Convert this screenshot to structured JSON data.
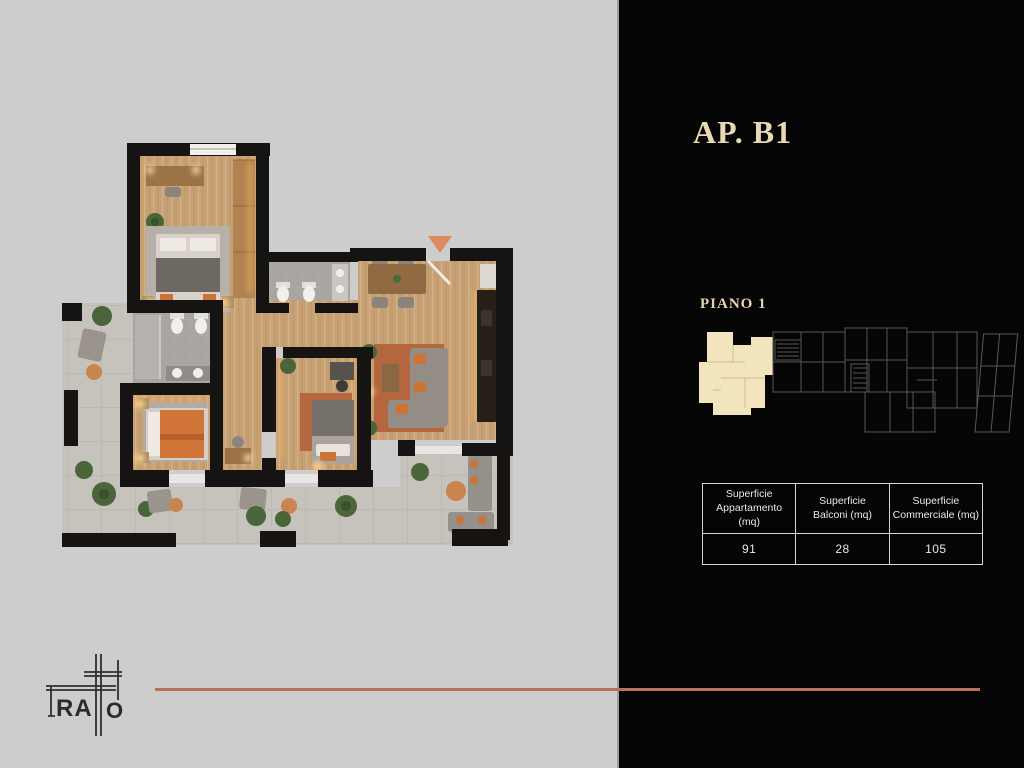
{
  "slide": {
    "apartment_title": "AP. B1",
    "floor_label": "PIANO 1"
  },
  "area_table": {
    "columns": [
      {
        "header_line1": "Superficie",
        "header_line2": "Appartamento (mq)",
        "value": "91"
      },
      {
        "header_line1": "Superficie",
        "header_line2": "Balconi (mq)",
        "value": "28"
      },
      {
        "header_line1": "Superficie",
        "header_line2": "Commerciale (mq)",
        "value": "105"
      }
    ]
  },
  "logo": {
    "brand": "TRATTO",
    "visible_letters": {
      "ra": "RA",
      "o": "O"
    }
  },
  "icons": {
    "entrance_marker": "triangle-down-icon"
  },
  "colors": {
    "accent_copper": "#b5745a",
    "title_cream": "#e9d9b3",
    "panel_black": "#050505",
    "canvas_gray": "#cdcdcd",
    "minimap_highlight": "#f2e5bd",
    "wall_black": "#161412",
    "wood_floor": "#c7a173",
    "terrace_tile": "#c6c2bc",
    "accent_orange": "#cd7335"
  }
}
